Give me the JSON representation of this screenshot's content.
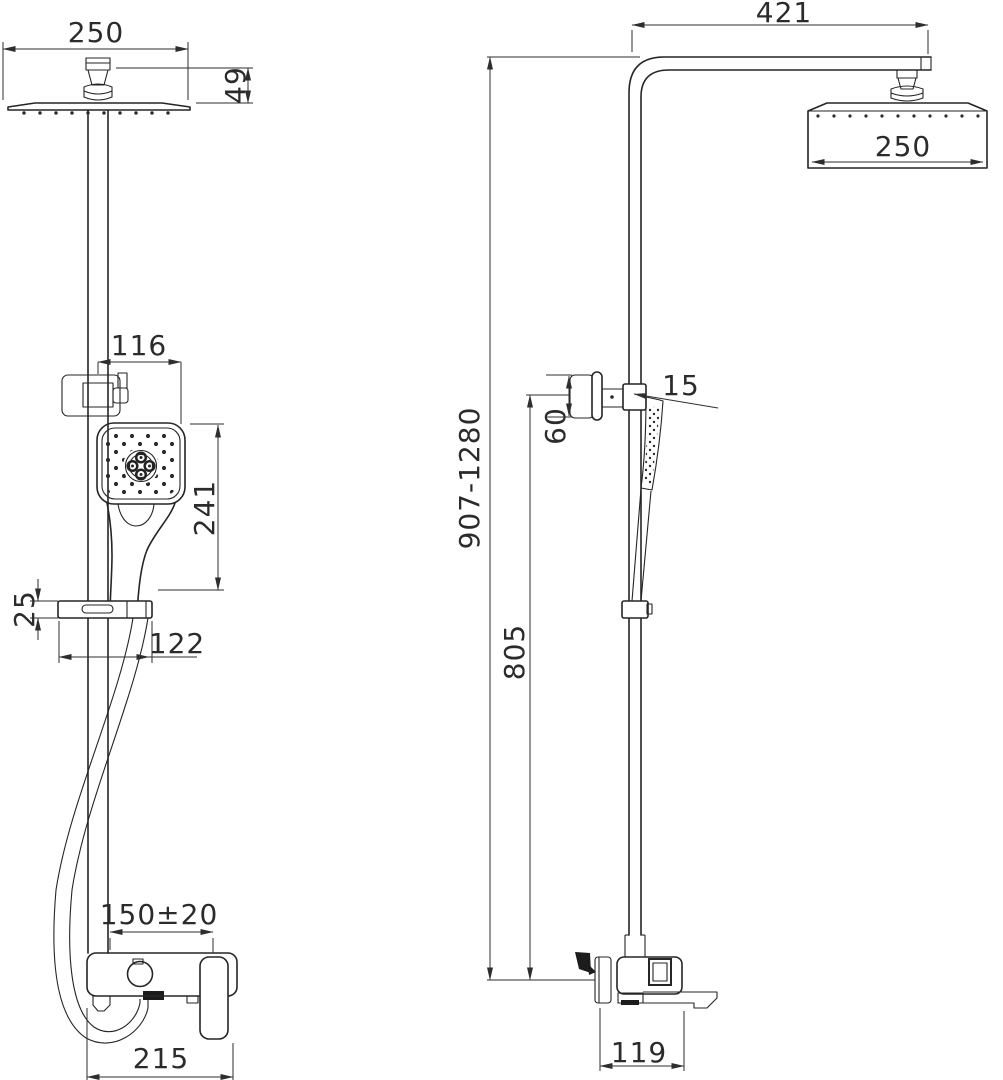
{
  "drawing": {
    "kind": "shower-column-technical-drawing",
    "views": {
      "front": {
        "name": "front-view"
      },
      "side": {
        "name": "side-view"
      }
    },
    "dims": {
      "front_head_width": "250",
      "front_head_height": "49",
      "front_handshower_offset": "116",
      "front_handshower_length": "241",
      "front_shelf_thickness": "25",
      "front_shelf_width": "122",
      "front_spout_reach": "150±20",
      "front_mixer_width": "215",
      "side_arm_length": "421",
      "side_head_depth": "250",
      "side_total_height": "907-1280",
      "side_bracket_height": "60",
      "side_handshower_angle": "15",
      "side_column_height": "805",
      "side_mixer_depth": "119"
    }
  }
}
